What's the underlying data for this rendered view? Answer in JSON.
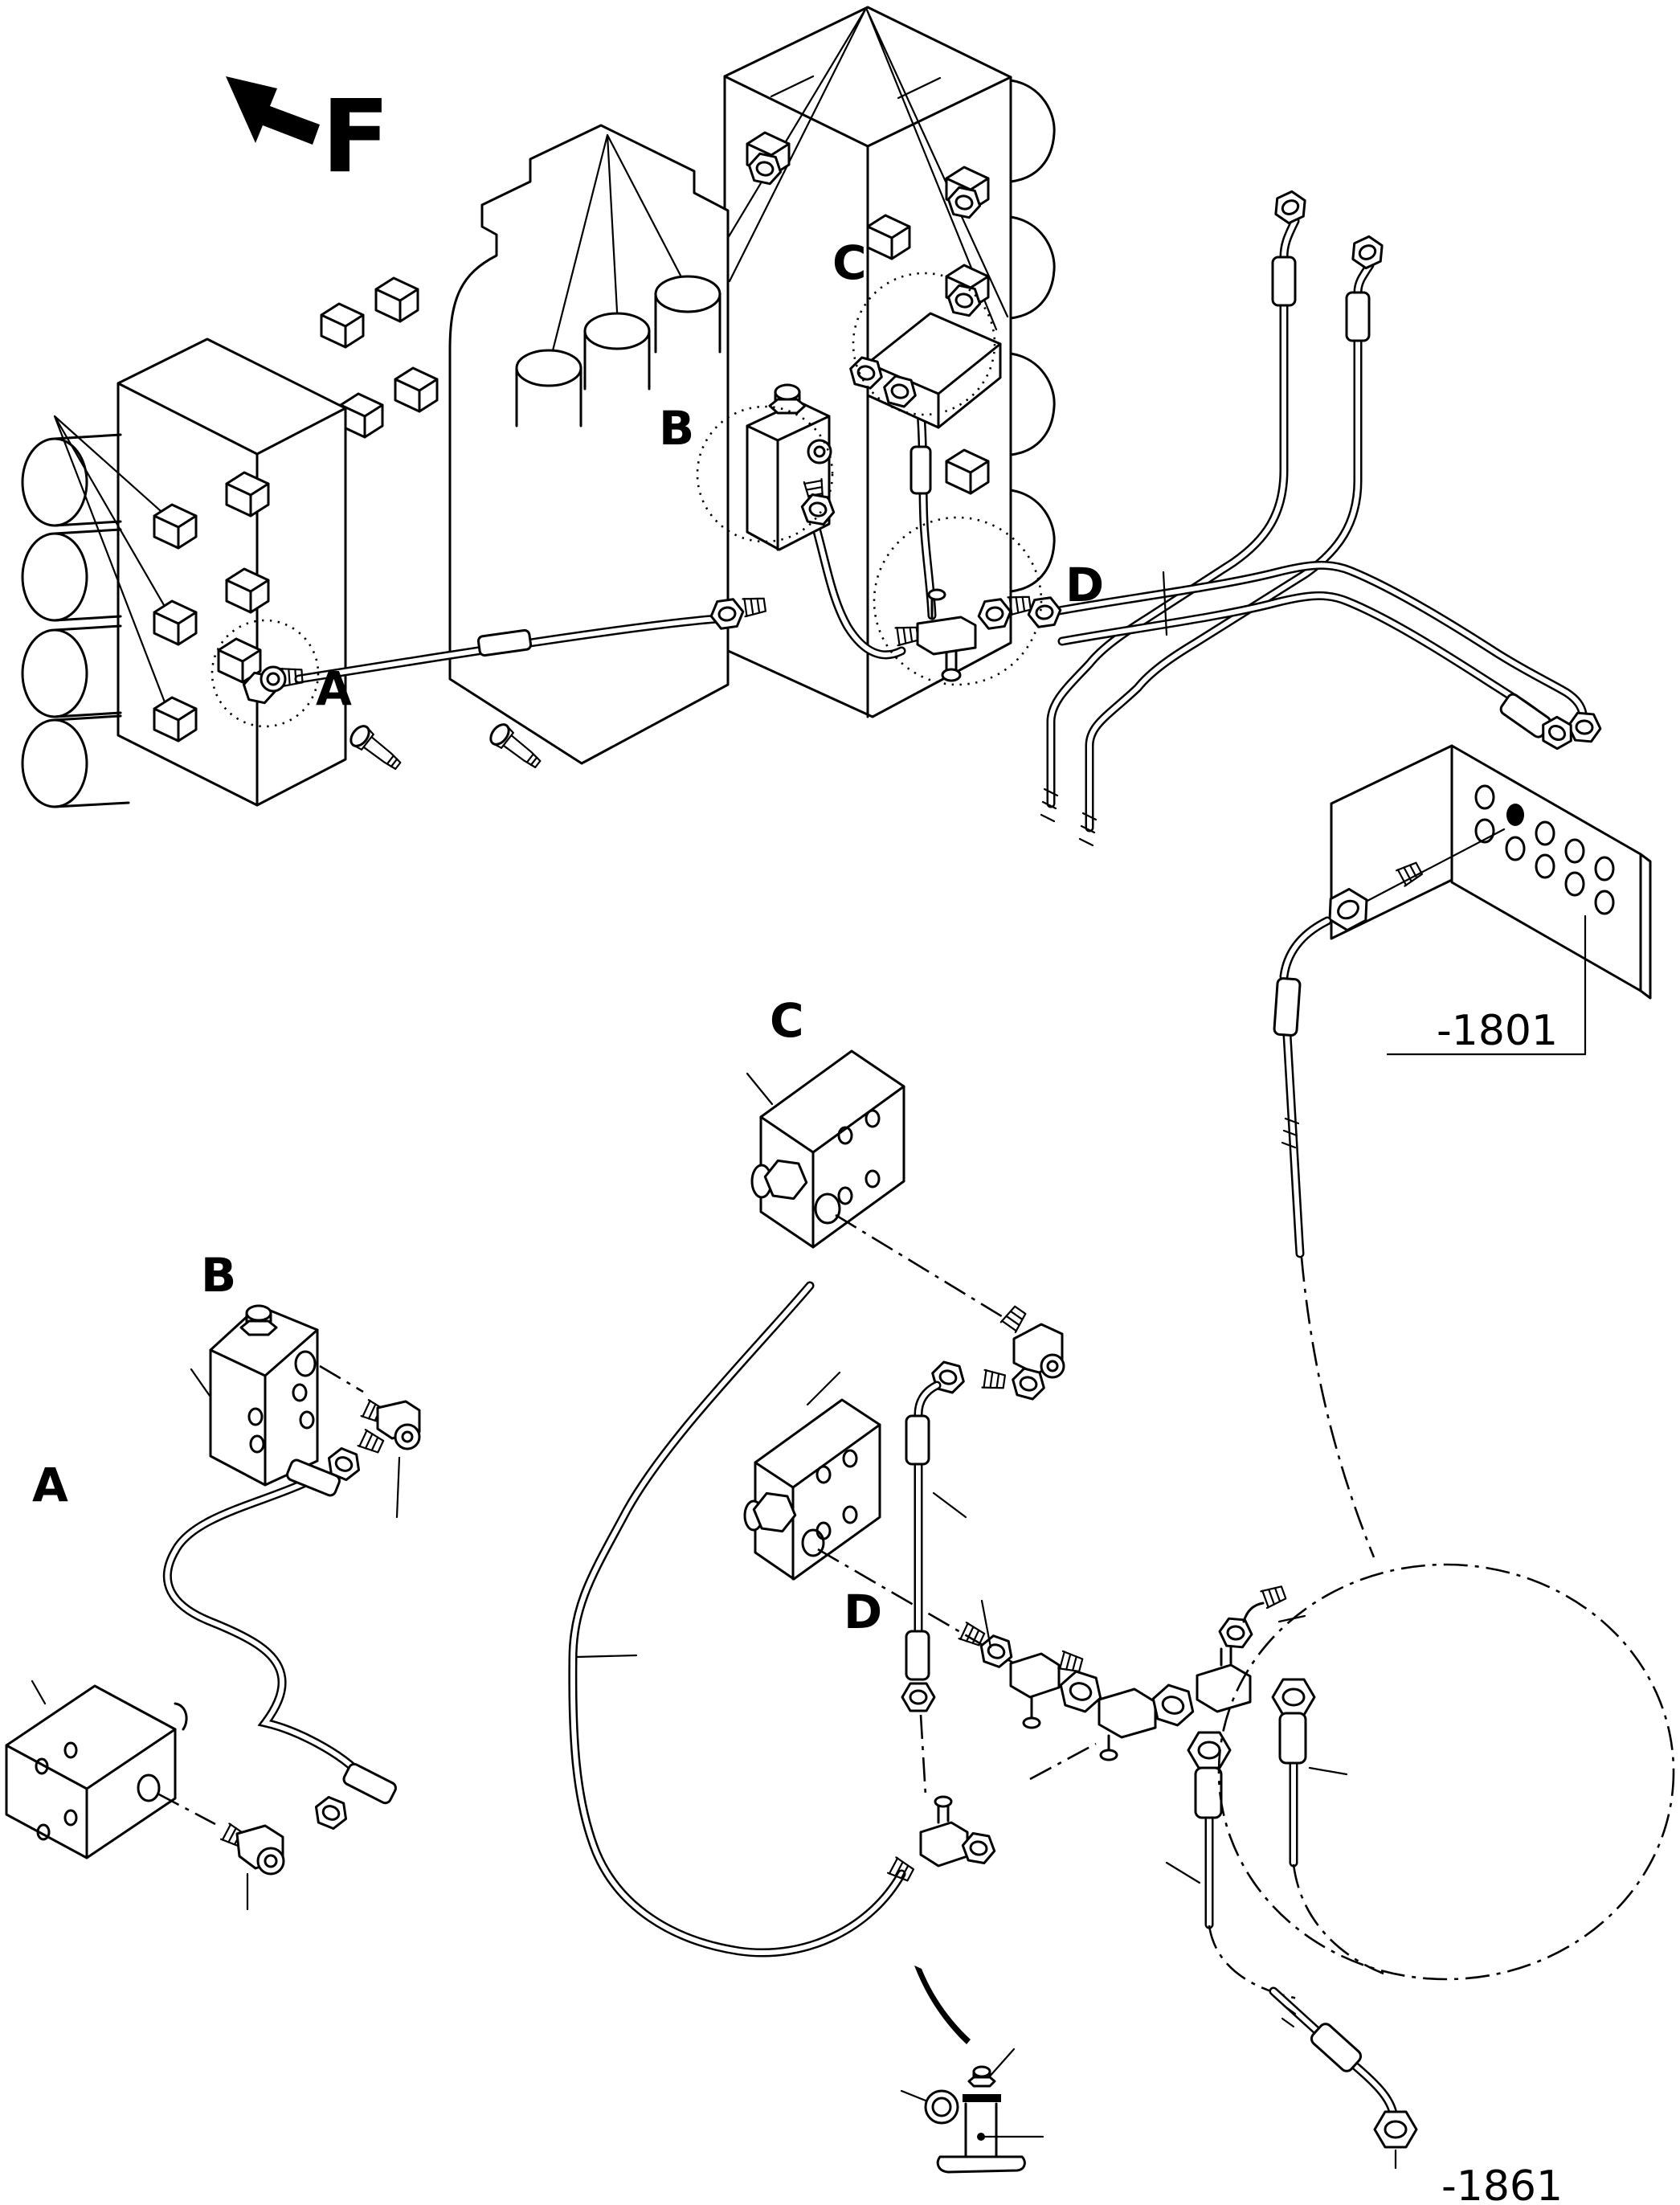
{
  "figure": {
    "type": "exploded-parts-line-diagram",
    "view_indicator": {
      "label": "F"
    },
    "callouts": {
      "a": "A",
      "b": "B",
      "c": "C",
      "d": "D"
    },
    "references": {
      "group_1801": "-1801",
      "group_1861": "-1861"
    },
    "colors": {
      "line": "#000000",
      "background": "#ffffff",
      "marked_hole": "#000000"
    }
  }
}
